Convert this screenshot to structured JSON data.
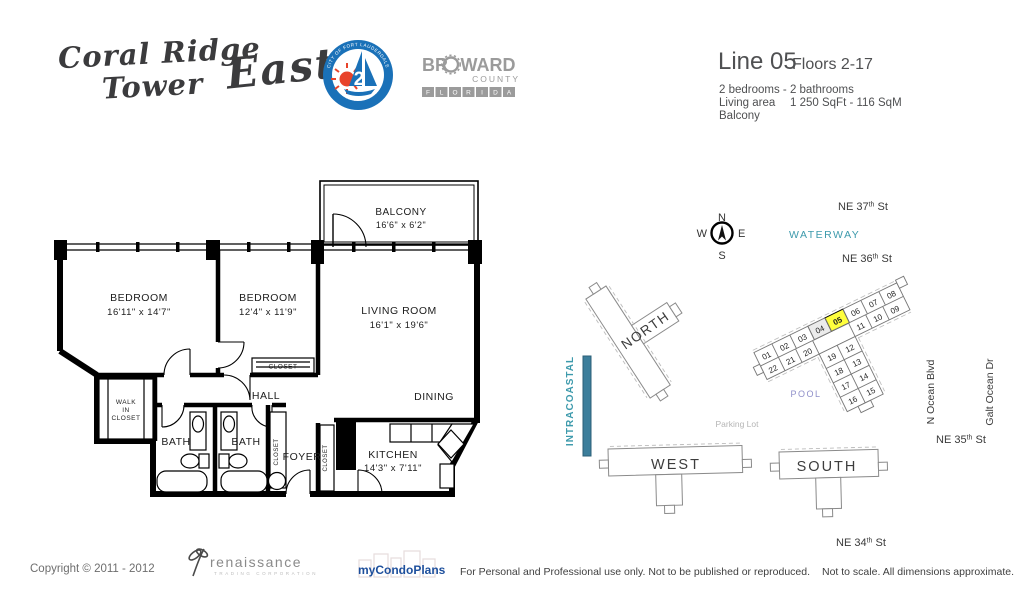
{
  "header": {
    "title_line1": "Coral Ridge",
    "title_line2": "Tower",
    "title_east": "East",
    "seal": {
      "ring_top": "CITY OF FORT LAUDERDALE",
      "ring_bottom": "VENICE OF AMERICA",
      "numeral": "2"
    },
    "broward": {
      "name_left": "BR",
      "name_right": "WARD",
      "county": "COUNTY",
      "florida": [
        "F",
        "L",
        "O",
        "R",
        "I",
        "D",
        "A"
      ]
    }
  },
  "unit_info": {
    "line": "Line 05",
    "floors": "Floors 2-17",
    "rooms": "2 bedrooms - 2 bathrooms",
    "living_area_label": "Living area",
    "living_area_value": "1 250 SqFt - 116 SqM",
    "balcony": "Balcony"
  },
  "floorplan": {
    "balcony_name": "BALCONY",
    "balcony_dims": "16'6\" x 6'2\"",
    "bedroom1_name": "BEDROOM",
    "bedroom1_dims": "16'11\" x 14'7\"",
    "bedroom2_name": "BEDROOM",
    "bedroom2_dims": "12'4\" x 11'9\"",
    "living_name": "LIVING ROOM",
    "living_dims": "16'1\" x 19'6\"",
    "kitchen_name": "KITCHEN",
    "kitchen_dims": "14'3\" x 7'11\"",
    "dining": "DINING",
    "hall": "HALL",
    "foyer": "FOYER",
    "bath1": "BATH",
    "bath2": "BATH",
    "closet_bedroom2": "CLOSET",
    "closet_foyer": "CLOSET",
    "closet_kitchen": "CLOSET",
    "walkin_line1": "WALK",
    "walkin_line2": "IN",
    "walkin_line3": "CLOSET"
  },
  "sitemap": {
    "compass": {
      "n": "N",
      "s": "S",
      "w": "W",
      "e": "E"
    },
    "streets": {
      "ne37_pre": "NE 37",
      "ne37_sup": "th",
      "ne37_post": " St",
      "ne36_pre": "NE 36",
      "ne36_sup": "th",
      "ne36_post": " St",
      "ne35_pre": "NE 35",
      "ne35_sup": "th",
      "ne35_post": " St",
      "ne34_pre": "NE 34",
      "ne34_sup": "th",
      "ne34_post": " St",
      "waterway": "WATERWAY",
      "intracoastal": "INTRACOASTAL",
      "n_ocean_blvd": "N Ocean Blvd",
      "galt_ocean_dr": "Galt Ocean Dr"
    },
    "labels": {
      "parking_lot": "Parking Lot",
      "pool": "POOL"
    },
    "buildings": {
      "north": "NORTH",
      "west": "WEST",
      "south": "SOUTH"
    },
    "east_units": {
      "top_row": [
        "01",
        "02",
        "03",
        "04",
        "05",
        "06",
        "07",
        "08"
      ],
      "bottom_left": [
        "22",
        "21",
        "20"
      ],
      "bottom_right": [
        "11",
        "10",
        "09"
      ],
      "stem_left": [
        "19",
        "18",
        "17",
        "16"
      ],
      "stem_right": [
        "12",
        "13",
        "14",
        "15"
      ],
      "highlighted_unit": "05"
    }
  },
  "footer": {
    "copyright": "Copyright © 2011 - 2012",
    "renaissance": "renaissance",
    "renaissance_sub": "TRADING CORPORATION",
    "mycondoplans": "myCondoPlans",
    "usage_note": "For Personal and Professional use only.  Not to be published or reproduced.",
    "scale_note": "Not to scale.  All dimensions approximate."
  },
  "colors": {
    "highlight_yellow": "#ffff3d",
    "teal_text": "#3d9aac",
    "intracoastal_bar": "#3c7e9b",
    "pool_text": "#8f8fc9",
    "seal_blue": "#1a71b8",
    "seal_red": "#e8432a",
    "broward_gray": "#9b9b9b",
    "condoplans_blue": "#1d4f9c"
  }
}
